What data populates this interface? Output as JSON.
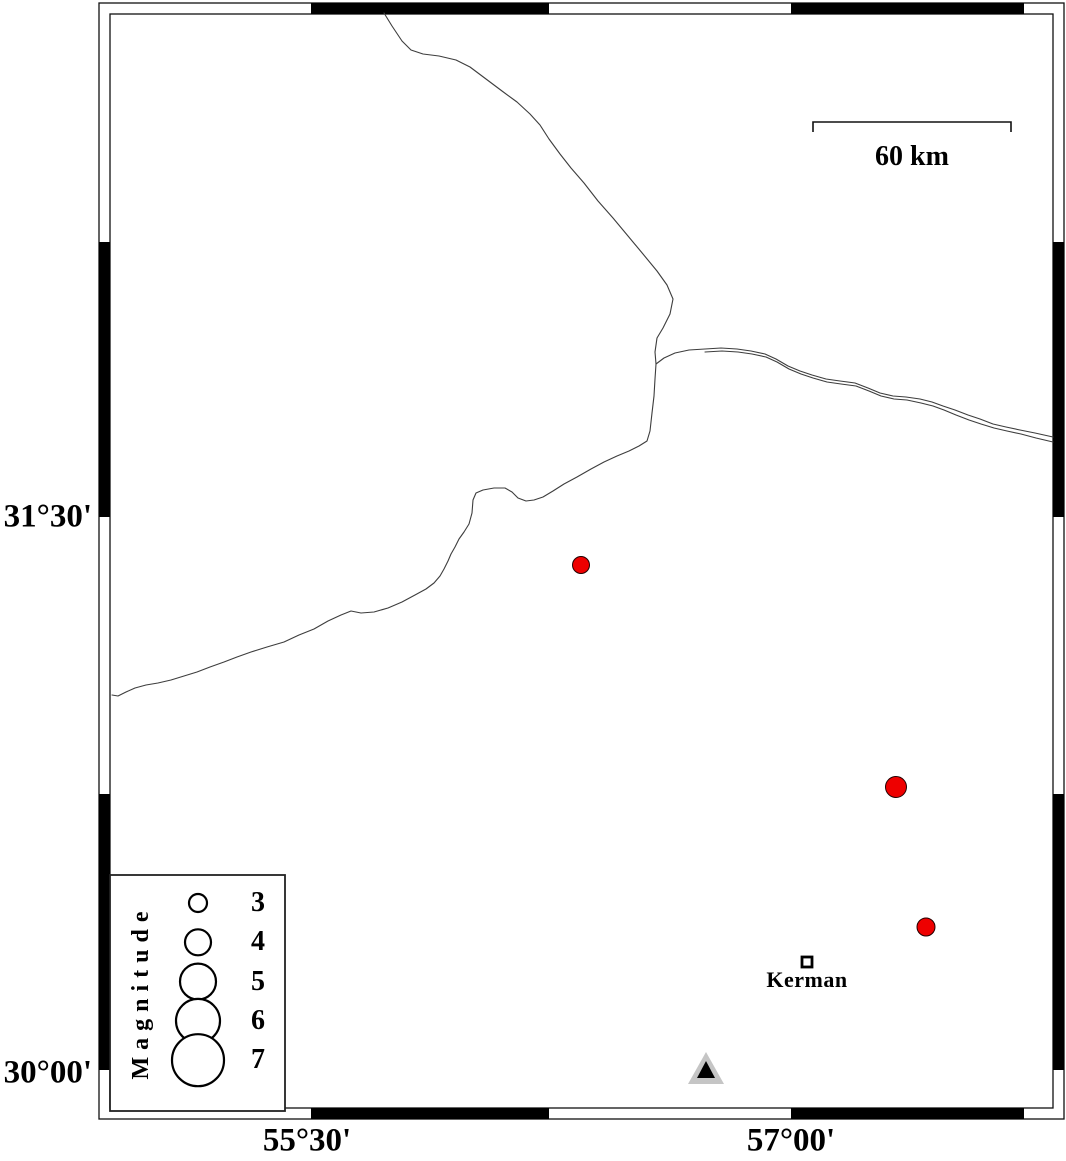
{
  "figure": {
    "type": "seismicity-map"
  },
  "axes": {
    "left": [
      {
        "label": "31°30'",
        "y": 517
      },
      {
        "label": "30°00'",
        "y": 1073
      }
    ],
    "bottom": [
      {
        "label": "55°30'",
        "x": 307
      },
      {
        "label": "57°00'",
        "x": 791
      }
    ]
  },
  "scale_bar": {
    "label": "60 km",
    "x1": 813,
    "x2": 1011,
    "y": 122
  },
  "city": {
    "label": "Kerman",
    "x": 807,
    "y": 962
  },
  "station": {
    "x": 706,
    "apex_y": 1052,
    "base_y": 1084,
    "half_width": 18
  },
  "legend": {
    "title": "Magnitude",
    "entries": [
      {
        "mag": "3",
        "r": 9
      },
      {
        "mag": "4",
        "r": 13
      },
      {
        "mag": "5",
        "r": 18
      },
      {
        "mag": "6",
        "r": 22
      },
      {
        "mag": "7",
        "r": 26
      }
    ],
    "circle_x": 198,
    "label_x": 258,
    "first_cy": 903,
    "row_step": 39.3
  },
  "epicenters": [
    {
      "x": 581,
      "y": 565,
      "r": 8.5
    },
    {
      "x": 896,
      "y": 787,
      "r": 10.5
    },
    {
      "x": 926,
      "y": 927,
      "r": 9
    }
  ],
  "colors": {
    "epicenter": "#ee0000",
    "epicenter_outline": "#220000",
    "station_outer": "#c5c5c5",
    "station_inner": "#000000",
    "line": "#3d3d3d",
    "frame": "#111111"
  },
  "rivers": [
    [
      384,
      13,
      392,
      26,
      402,
      41,
      411,
      50,
      423,
      54,
      439,
      56,
      456,
      60,
      470,
      67,
      486,
      79,
      502,
      91,
      517,
      102,
      530,
      114,
      540,
      125,
      549,
      139,
      560,
      154,
      571,
      168,
      584,
      183,
      598,
      201,
      613,
      218,
      628,
      236,
      643,
      254,
      657,
      271,
      667,
      285,
      673,
      299,
      670,
      314,
      663,
      328,
      657,
      338,
      655,
      352,
      656,
      364,
      655,
      379,
      654,
      396,
      652,
      413,
      650,
      431,
      647,
      441,
      639,
      446,
      629,
      451,
      617,
      456,
      604,
      462,
      591,
      469,
      577,
      477,
      564,
      484,
      553,
      491,
      543,
      497,
      534,
      500,
      526,
      501,
      518,
      498,
      512,
      492,
      505,
      488,
      494,
      488,
      483,
      490,
      476,
      493,
      473,
      500,
      472,
      513,
      469,
      524,
      464,
      532,
      459,
      539,
      455,
      547,
      451,
      554,
      448,
      561,
      444,
      569,
      440,
      576,
      434,
      583,
      426,
      589,
      415,
      595,
      402,
      602,
      388,
      608,
      374,
      612,
      361,
      613,
      351,
      611,
      341,
      615,
      328,
      621,
      314,
      629,
      299,
      635,
      284,
      642,
      267,
      647,
      251,
      652,
      237,
      657,
      224,
      662,
      210,
      667,
      197,
      672,
      184,
      676,
      171,
      680,
      158,
      683,
      146,
      685,
      135,
      688,
      126,
      692,
      118,
      696,
      112,
      695
    ],
    [
      656,
      364,
      664,
      358,
      675,
      353,
      689,
      350,
      705,
      349,
      721,
      348,
      737,
      349,
      751,
      351,
      765,
      354,
      776,
      359,
      788,
      366,
      800,
      371,
      812,
      375,
      826,
      379,
      840,
      381,
      855,
      383,
      868,
      388,
      880,
      393,
      893,
      396,
      906,
      397,
      920,
      399,
      932,
      402,
      943,
      406,
      955,
      410,
      968,
      415,
      980,
      419,
      993,
      424,
      1006,
      427,
      1020,
      430,
      1035,
      433,
      1053,
      437
    ],
    [
      705,
      352,
      722,
      351,
      738,
      352,
      752,
      354,
      766,
      357,
      777,
      362,
      789,
      369,
      801,
      374,
      813,
      378,
      827,
      382,
      841,
      384,
      856,
      386,
      869,
      391,
      881,
      396,
      894,
      399,
      907,
      400,
      921,
      403,
      933,
      406,
      944,
      410,
      956,
      415,
      969,
      420,
      981,
      424,
      994,
      428,
      1007,
      431,
      1021,
      434,
      1036,
      438,
      1053,
      442
    ]
  ]
}
